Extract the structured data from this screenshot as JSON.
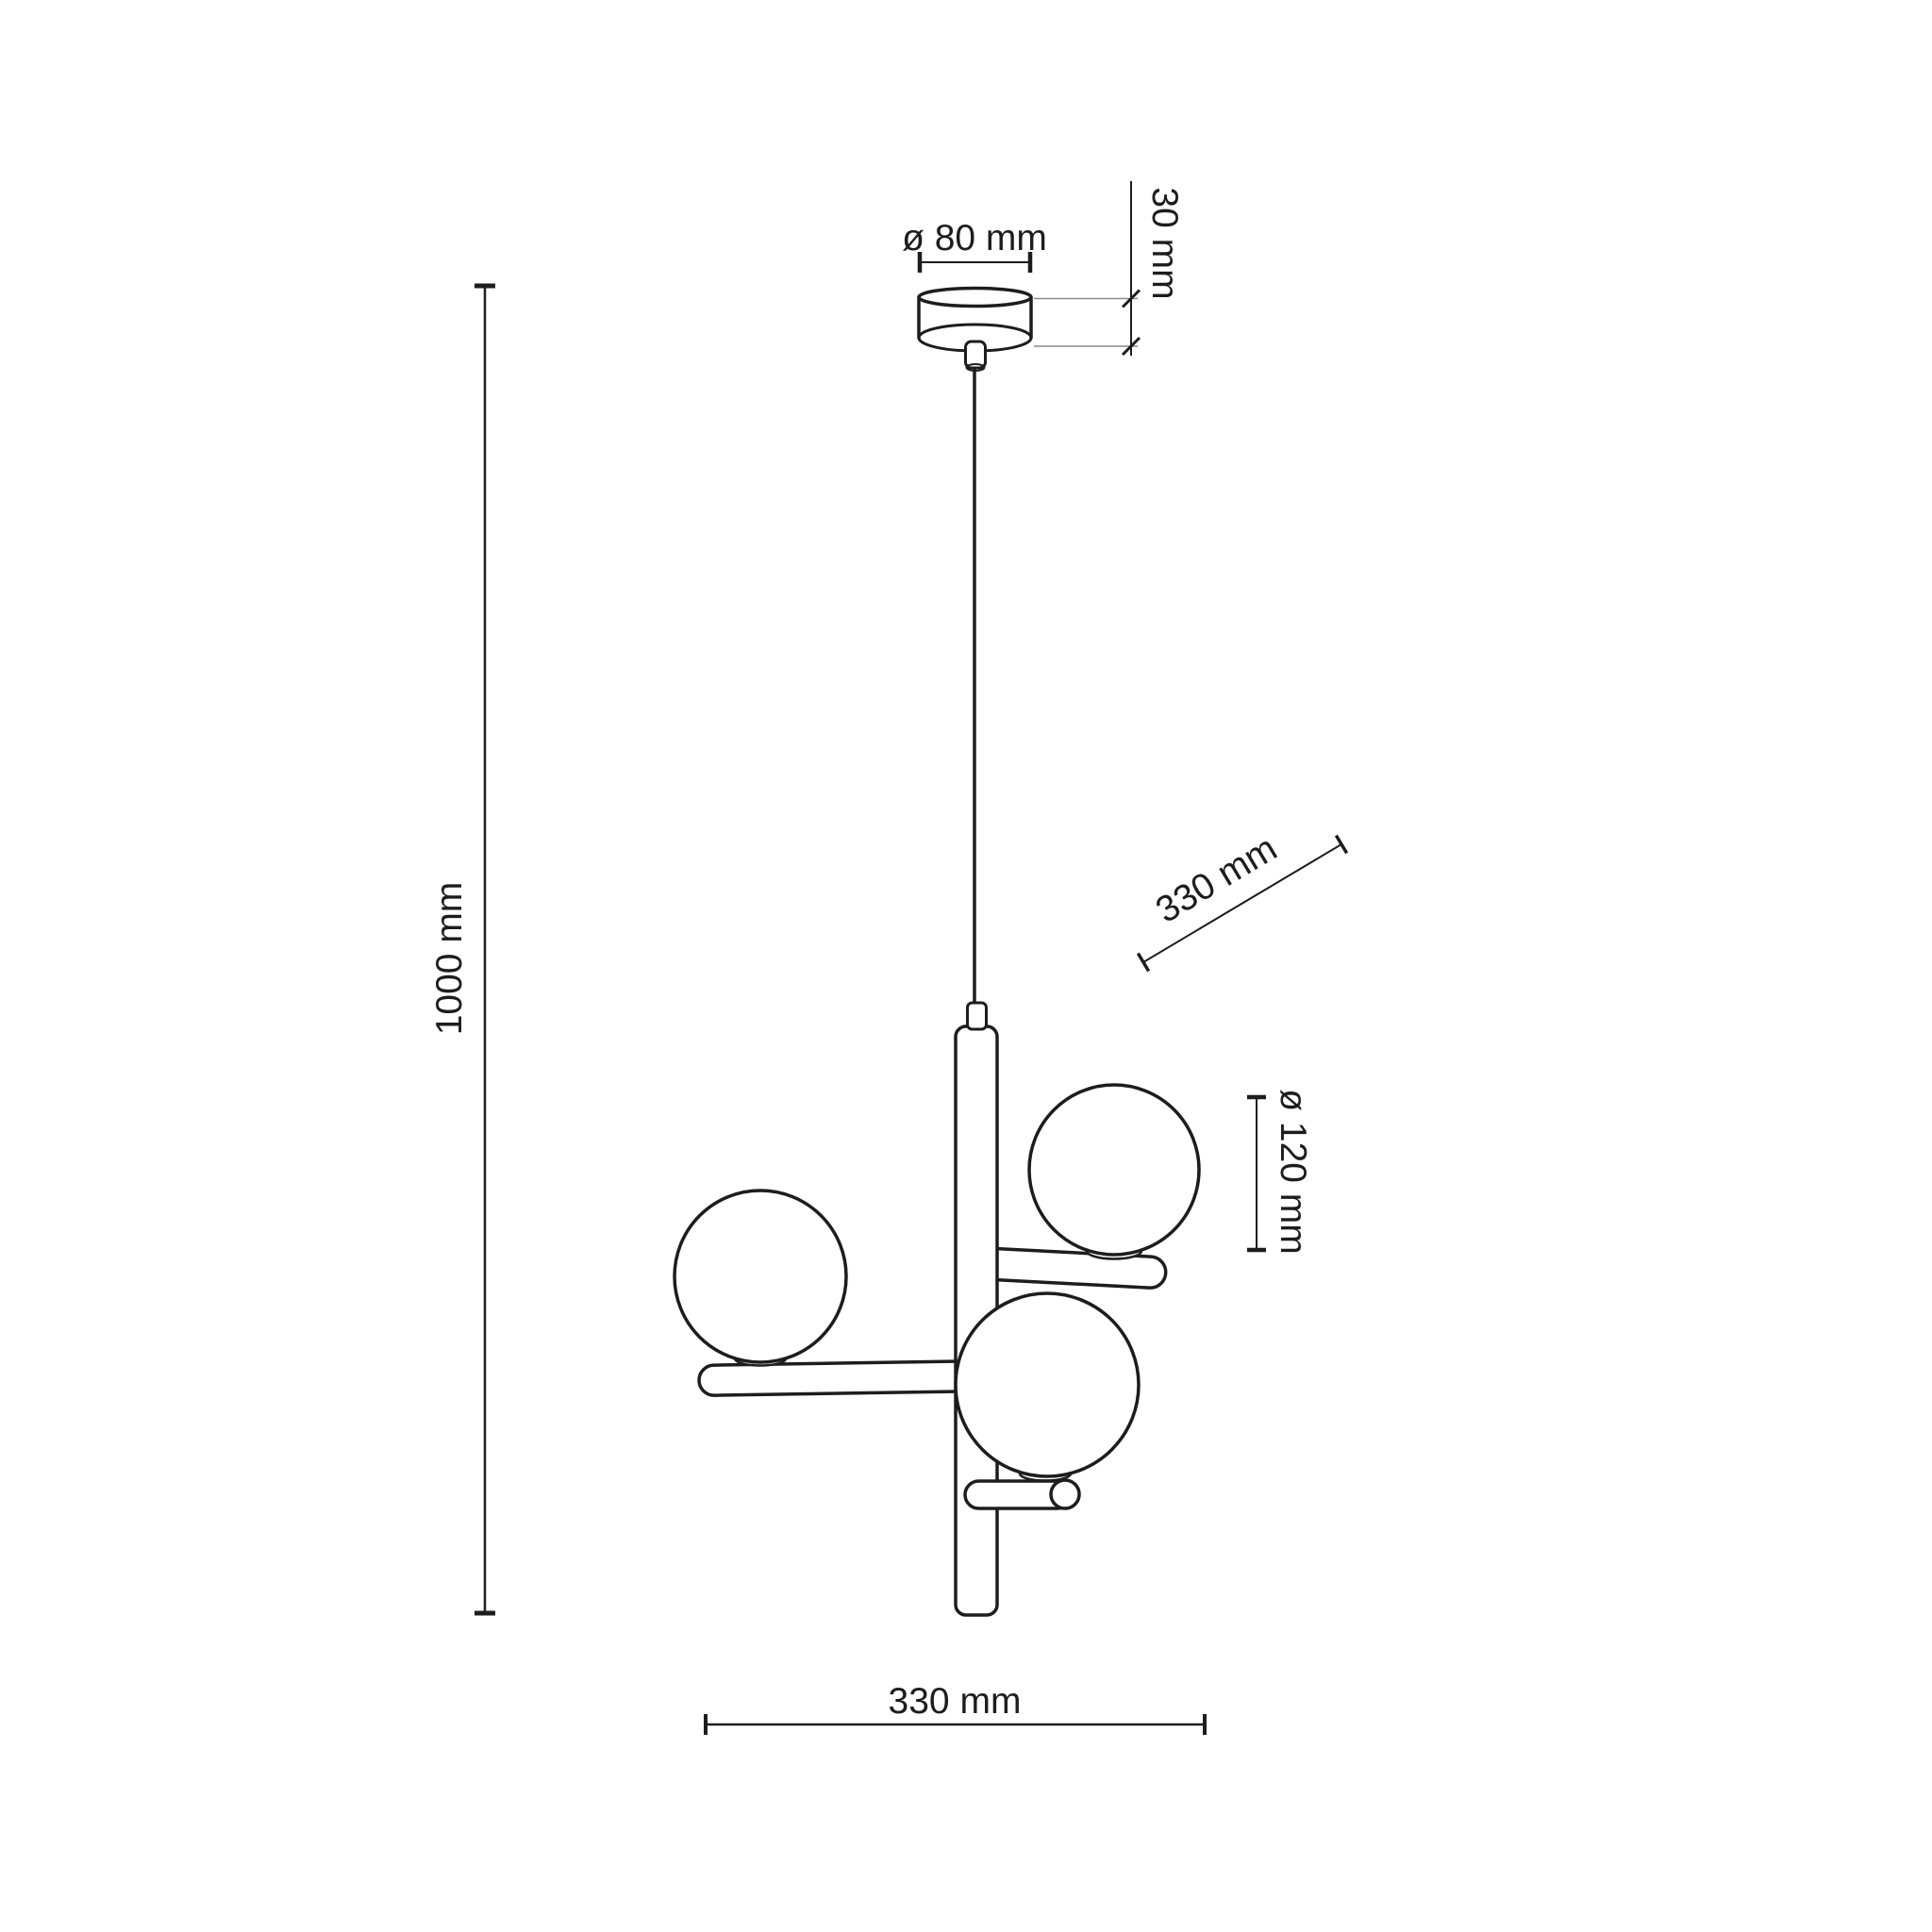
{
  "drawing": {
    "subject": "pendant-lamp-dimension-drawing",
    "colors": {
      "background": "#ffffff",
      "line": "#1d1d1d",
      "extension": "#8a8a8a"
    },
    "labels": {
      "canopy_diameter": "ø 80 mm",
      "canopy_height": "30 mm",
      "rod_length": "330 mm",
      "globe_diameter": "ø 120 mm",
      "total_height": "1000 mm",
      "total_width": "330 mm"
    }
  }
}
